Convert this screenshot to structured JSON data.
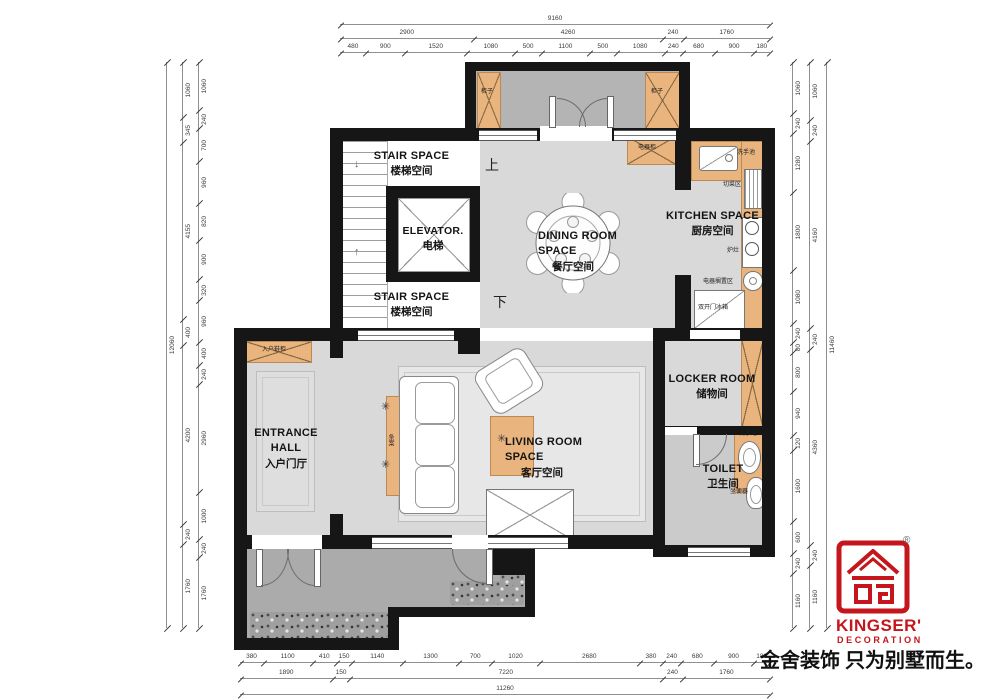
{
  "colors": {
    "wall": "#161616",
    "floor": "#d9d9d9",
    "terrace": "#ababab",
    "cabinet": "#eab47e",
    "brand_red": "#c4161c"
  },
  "rooms": {
    "stair_top": {
      "en": "STAIR SPACE",
      "zh": "楼梯空间"
    },
    "stair_bottom": {
      "en": "STAIR SPACE",
      "zh": "楼梯空间"
    },
    "elevator": {
      "en": "ELEVATOR.",
      "zh": "电梯"
    },
    "dining": {
      "en": "DINING ROOM SPACE",
      "zh": "餐厅空间"
    },
    "kitchen": {
      "en": "KITCHEN SPACE",
      "zh": "厨房空间"
    },
    "locker": {
      "en": "LOCKER ROOM",
      "zh": "储物间"
    },
    "toilet": {
      "en": "TOILET",
      "zh": "卫生间"
    },
    "entrance": {
      "en": "ENTRANCE HALL",
      "zh": "入户门厅"
    },
    "living": {
      "en": "LIVING ROOM SPACE",
      "zh": "客厅空间"
    }
  },
  "markers": {
    "up": "上",
    "down": "下"
  },
  "annotations": [
    {
      "name": "label-porch-cabinet-left",
      "text": "柜子",
      "x": 481,
      "y": 89
    },
    {
      "name": "label-porch-cabinet-right",
      "text": "柜子",
      "x": 651,
      "y": 89
    },
    {
      "name": "label-appliance-cabinet",
      "text": "电器柜",
      "x": 638,
      "y": 145
    },
    {
      "name": "label-kitchen-sink",
      "text": "洗手池",
      "x": 737,
      "y": 150
    },
    {
      "name": "label-cutting-area",
      "text": "切菜区",
      "x": 723,
      "y": 182
    },
    {
      "name": "label-stove",
      "text": "炉灶",
      "x": 727,
      "y": 248
    },
    {
      "name": "label-appliance-area",
      "text": "电器搁置区",
      "x": 703,
      "y": 279
    },
    {
      "name": "label-fridge",
      "text": "双开门冰箱",
      "x": 698,
      "y": 305
    },
    {
      "name": "label-shoe-cabinet",
      "text": "入户鞋柜",
      "x": 262,
      "y": 347
    },
    {
      "name": "label-console-table",
      "text": "条案",
      "x": 387,
      "y": 434,
      "vertical": true
    },
    {
      "name": "label-toilet-sink",
      "text": "洗手池",
      "x": 739,
      "y": 431
    },
    {
      "name": "label-toilet-seat",
      "text": "坐便器",
      "x": 730,
      "y": 489
    }
  ],
  "dimensions": {
    "top_total": [
      "9160"
    ],
    "top_groups": [
      "2900",
      "4260",
      "240",
      "1760"
    ],
    "top_detail": [
      "480",
      "900",
      "1520",
      "1080",
      "500",
      "1100",
      "500",
      "1080",
      "240",
      "680",
      "900",
      "180"
    ],
    "left_total": [
      "12060"
    ],
    "left_groups": [
      "1060",
      "345",
      "4155",
      "400",
      "4200",
      "240",
      "1760"
    ],
    "left_detail": [
      "1060",
      "240",
      "700",
      "960",
      "820",
      "900",
      "320",
      "960",
      "400",
      "240",
      "2960",
      "1000",
      "240",
      "1760"
    ],
    "right_total": [
      "11460"
    ],
    "right_groups": [
      "1060",
      "240",
      "4160",
      "240",
      "4360",
      "240",
      "1160"
    ],
    "right_detail": [
      "1060",
      "240",
      "1280",
      "1800",
      "1080",
      "240",
      "80",
      "800",
      "940",
      "120",
      "1600",
      "600",
      "240",
      "1160"
    ],
    "bottom_total": [
      "11260"
    ],
    "bottom_groups": [
      "1890",
      "150",
      "7220",
      "240",
      "1760"
    ],
    "bottom_detail": [
      "380",
      "1100",
      "410",
      "150",
      "1140",
      "1300",
      "700",
      "1020",
      "2680",
      "380",
      "240",
      "680",
      "900",
      "180"
    ]
  },
  "brand": {
    "name": "KINGSER'",
    "sub": "DECORATION",
    "registered": "®",
    "tagline": "金舍装饰 只为别墅而生。"
  }
}
